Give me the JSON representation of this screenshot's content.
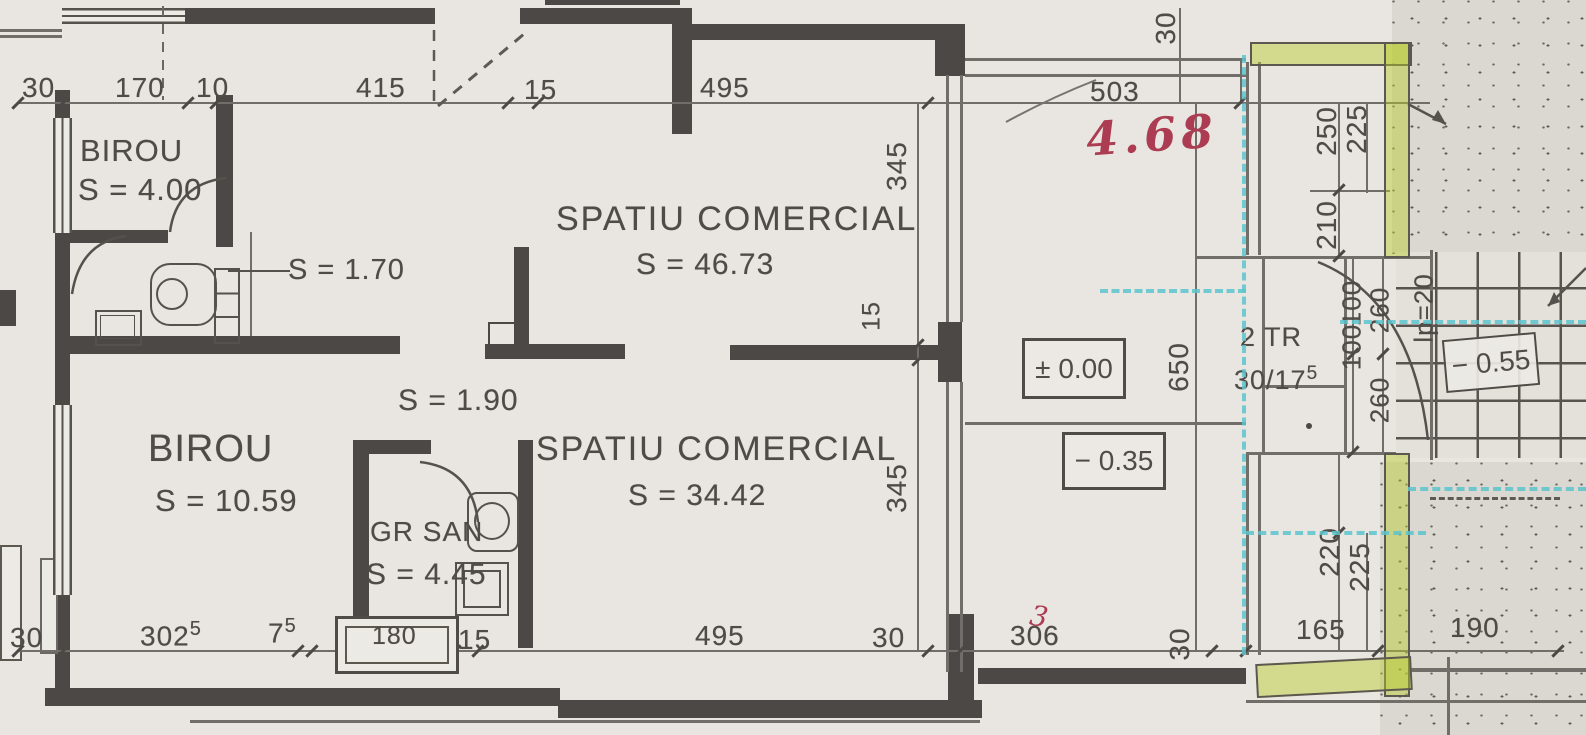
{
  "rooms": {
    "birou_top": {
      "name": "BIROU",
      "area": "S = 4.00"
    },
    "wc": {
      "area": "S = 1.70"
    },
    "hall": {
      "area": "S = 1.90"
    },
    "birou_main": {
      "name": "BIROU",
      "area": "S = 10.59"
    },
    "gr_san": {
      "name": "GR SAN",
      "area": "S = 4.45"
    },
    "spatiu_comercial_top": {
      "name": "SPATIU COMERCIAL",
      "area": "S = 46.73"
    },
    "spatiu_comercial_bottom": {
      "name": "SPATIU COMERCIAL",
      "area": "S = 34.42"
    }
  },
  "levels": {
    "zero": "± 0.00",
    "minus35": "− 0.35",
    "minus55": "− 0.55"
  },
  "stair": {
    "treads": "2 TR",
    "ratio": "30/17",
    "ratio_sup": "5",
    "landing": "lp=20"
  },
  "dims": {
    "top": {
      "d30": "30",
      "d170": "170",
      "d10": "10",
      "d415": "415",
      "d15": "15",
      "d495": "495",
      "d503": "503",
      "v30": "30"
    },
    "bottom": {
      "d30": "30",
      "d302": "302",
      "d302_sup": "5",
      "d7": "7",
      "d7_sup": "5",
      "d180": "180",
      "d15": "15",
      "d495": "495",
      "d30b": "30",
      "d306": "306",
      "v30": "30",
      "d165": "165",
      "d190": "190"
    },
    "right": {
      "d250": "250",
      "d225": "225",
      "d210": "210",
      "d100a": "100",
      "d100b": "100",
      "d260a": "260",
      "d260b": "260",
      "d220": "220",
      "d225b": "225"
    },
    "inner": {
      "d345a": "345",
      "d15": "15",
      "d345b": "345",
      "d650": "650"
    }
  },
  "annotations": {
    "handwritten_total": "4.68",
    "handwritten_mark": "3"
  },
  "colors": {
    "highlight_green": "#b9cd2a",
    "marker_cyan": "#5cc4ce",
    "handwriting_red": "#ab3c52",
    "wall": "#4c4845"
  }
}
